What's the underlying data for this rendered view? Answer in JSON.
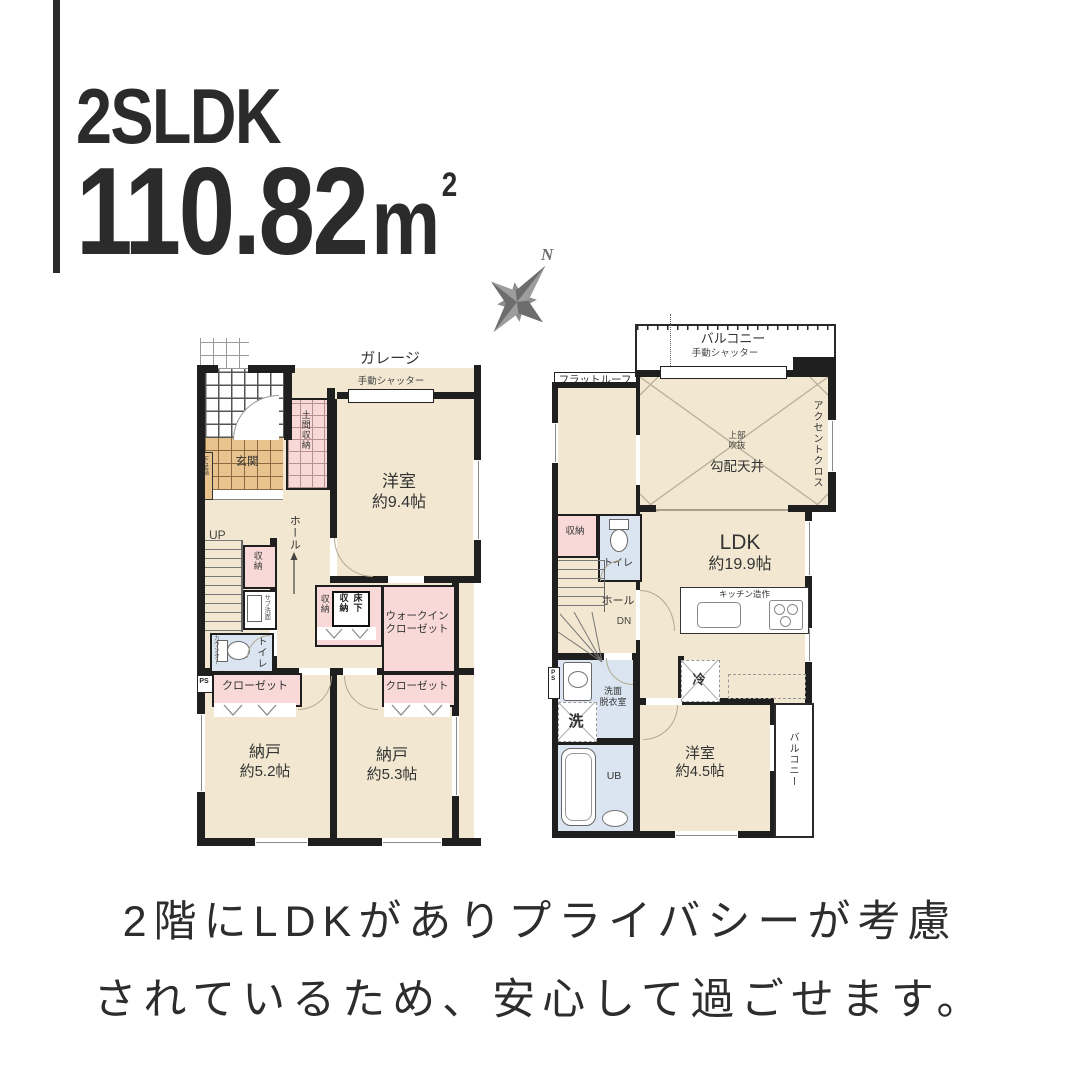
{
  "header": {
    "plan_type": "2SLDK",
    "area": "110.82",
    "area_unit": "m",
    "area_sup": "2"
  },
  "compass": {
    "north": "N"
  },
  "floor1": {
    "garage": "ガレージ",
    "garage_shutter": "手動シャッター",
    "genkan": "玄関",
    "shoe_cabinet": "下足箱",
    "doma_storage": "土間収納",
    "western_room": "洋室",
    "western_room_size": "約9.4帖",
    "up": "UP",
    "hall": "ホール",
    "closet_small": "収納",
    "sub_basin": "サブ洗面",
    "toilet": "トイレ",
    "counter": "カウンター",
    "ps": "PS",
    "closet_left": "クローゼット",
    "closet_right": "クローゼット",
    "wic_line1": "ウォークイン",
    "wic_line2": "クローゼット",
    "center_storage": "収納",
    "underfloor_col1": "床下",
    "underfloor_col2": "収納",
    "storeroom_left": "納戸",
    "storeroom_left_size": "約5.2帖",
    "storeroom_right": "納戸",
    "storeroom_right_size": "約5.3帖"
  },
  "floor2": {
    "balcony_top": "バルコニー",
    "balcony_shutter": "手動シャッター",
    "flat_roof": "フラットルーフ",
    "void_line1": "上部",
    "void_line2": "吹抜",
    "sloped_ceiling": "勾配天井",
    "accent_cloth": "アクセントクロス",
    "ldk": "LDK",
    "ldk_size": "約19.9帖",
    "storage": "収納",
    "toilet": "トイレ",
    "hall": "ホール",
    "down": "DN",
    "kitchen_counter": "キッチン造作",
    "fridge": "冷",
    "washroom_line1": "洗面",
    "washroom_line2": "脱衣室",
    "washer": "洗",
    "unit_bath": "UB",
    "ps": "PS",
    "western_room": "洋室",
    "western_room_size": "約4.5帖",
    "balcony_right": "バルコニー"
  },
  "caption": {
    "line1": "2階にLDKがありプライバシーが考慮",
    "line2": "されているため、安心して過ごせます。"
  },
  "colors": {
    "wall": "#1f1f1f",
    "room_beige": "#f2e8d1",
    "genkan_orange": "#e9c38d",
    "closet_pink": "#f8d9d8",
    "wet_blue": "#dae5f1",
    "accent_text": "#2b2b2b",
    "compass_gray": "#6d6d6d"
  }
}
